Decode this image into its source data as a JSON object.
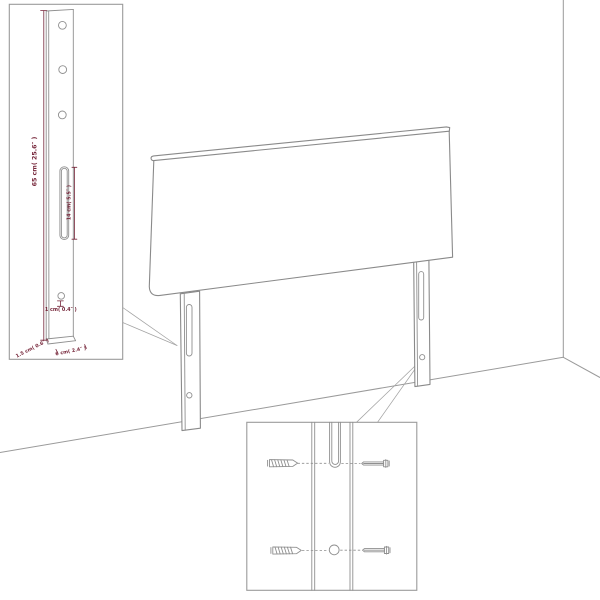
{
  "diagram": {
    "title": "headboard-assembly-dimension-diagram",
    "subject": "upholstered headboard with two mounting legs shown against a room corner, with leg detail inset and screw mounting inset",
    "colors": {
      "line": "#8a8a8a",
      "thin_line": "#a3a3a3",
      "dimension_text": "#76263a",
      "background": "#ffffff"
    },
    "labels": {
      "leg_height": "65 cm( 25.6″ )",
      "slot_length": "14 cm( 5.5″ )",
      "hole_offset": "1 cm( 0.4″ )",
      "leg_depth": "1.5 cm( 0.6″ )",
      "leg_width": "6 cm( 2.4″ )"
    },
    "icons": {
      "wood_screw": "hatched tapered screw",
      "machine_screw": "slotted head bolt",
      "keyhole_slot": "vertical slot",
      "mounting_hole": "round hole"
    }
  }
}
